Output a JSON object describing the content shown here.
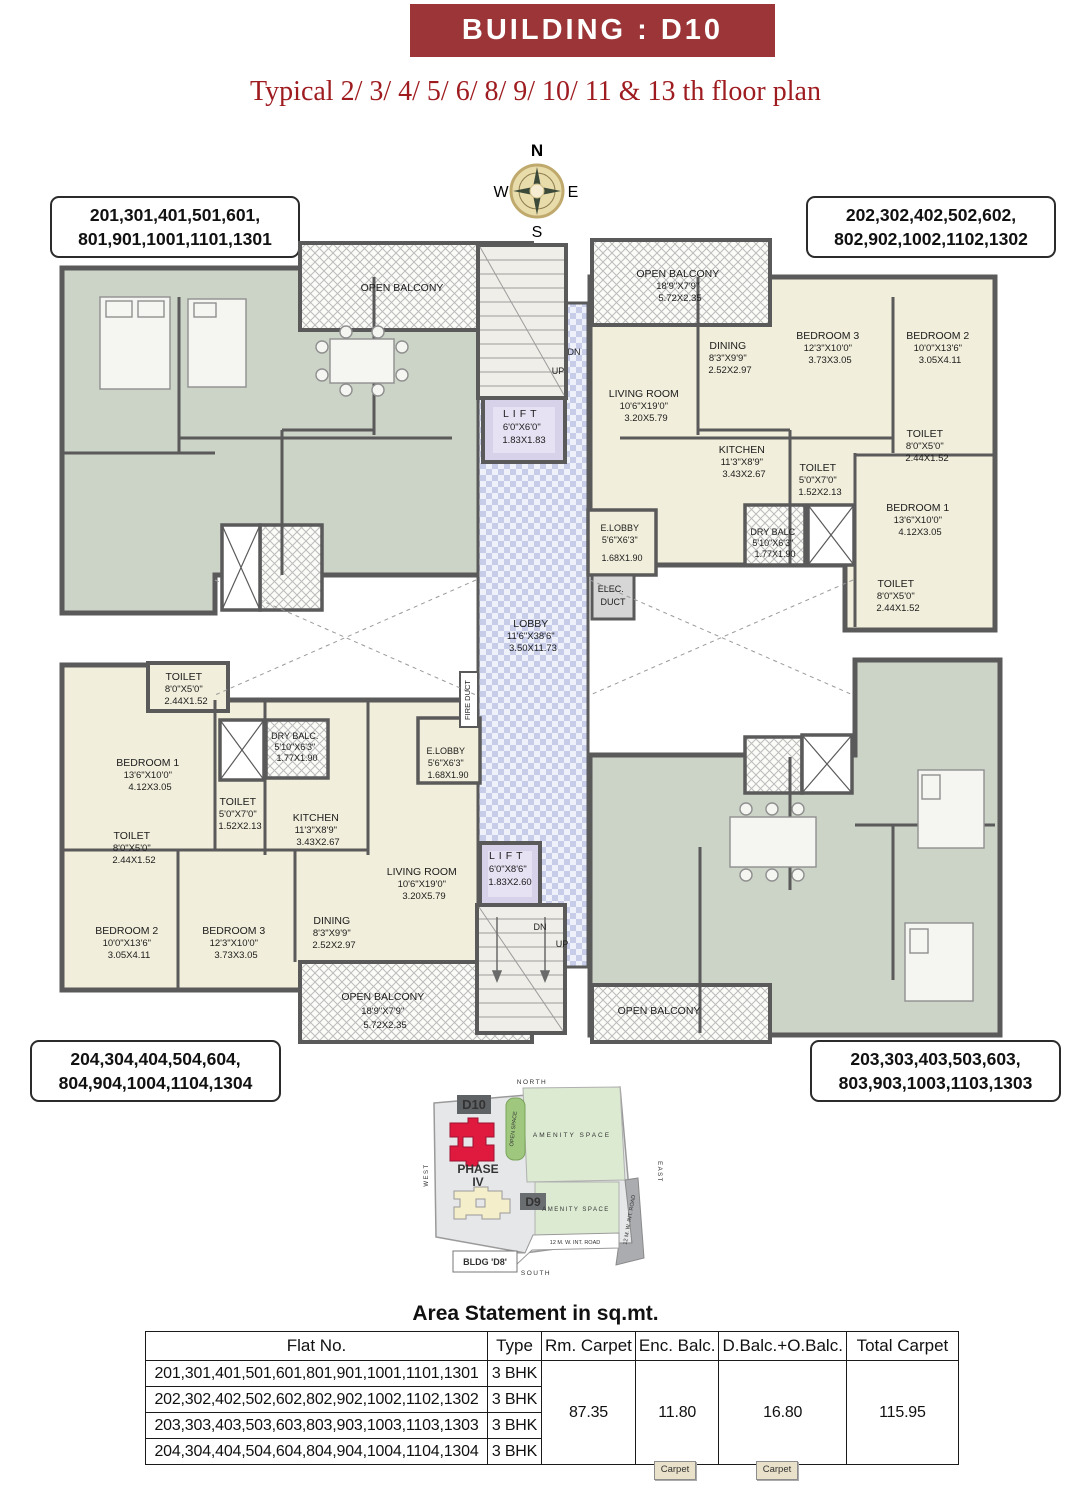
{
  "header": {
    "title": "BUILDING : D10",
    "subtitle": "Typical 2/ 3/ 4/ 5/ 6/ 8/ 9/ 10/ 11 & 13 th floor plan"
  },
  "compass": {
    "n": "N",
    "e": "E",
    "s": "S",
    "w": "W"
  },
  "unit_labels": {
    "top_left": [
      "201,301,401,501,601,",
      "801,901,1001,1101,1301"
    ],
    "top_right": [
      "202,302,402,502,602,",
      "802,902,1002,1102,1302"
    ],
    "bottom_left": [
      "204,304,404,504,604,",
      "804,904,1004,1104,1304"
    ],
    "bottom_right": [
      "203,303,403,503,603,",
      "803,903,1003,1103,1303"
    ]
  },
  "plan": {
    "rooms": {
      "tr_open_balcony": {
        "name": "OPEN BALCONY",
        "ft": "18'9\"X7'9\"",
        "m": "5.72X2.35"
      },
      "tr_dining": {
        "name": "DINING",
        "ft": "8'3\"X9'9\"",
        "m": "2.52X2.97"
      },
      "tr_bedroom3": {
        "name": "BEDROOM 3",
        "ft": "12'3\"X10'0\"",
        "m": "3.73X3.05"
      },
      "tr_bedroom2": {
        "name": "BEDROOM 2",
        "ft": "10'0\"X13'6\"",
        "m": "3.05X4.11"
      },
      "tr_living": {
        "name": "LIVING ROOM",
        "ft": "10'6\"X19'0\"",
        "m": "3.20X5.79"
      },
      "tr_kitchen": {
        "name": "KITCHEN",
        "ft": "11'3\"X8'9\"",
        "m": "3.43X2.67"
      },
      "tr_toilet_mid": {
        "name": "TOILET",
        "ft": "5'0\"X7'0\"",
        "m": "1.52X2.13"
      },
      "tr_toilet_top": {
        "name": "TOILET",
        "ft": "8'0\"X5'0\"",
        "m": "2.44X1.52"
      },
      "tr_bedroom1": {
        "name": "BEDROOM 1",
        "ft": "13'6\"X10'0\"",
        "m": "4.12X3.05"
      },
      "tr_toilet_bottom": {
        "name": "TOILET",
        "ft": "8'0\"X5'0\"",
        "m": "2.44X1.52"
      },
      "tr_dry_balc": {
        "name": "DRY BALC",
        "ft": "5'10\"X6'3\"",
        "m": "1.77X1.90"
      },
      "tr_e_lobby": {
        "name": "E.LOBBY",
        "ft": "5'6\"X6'3\"",
        "m": "1.68X1.90"
      },
      "elec_duct": {
        "line1": "ELEC.",
        "line2": "DUCT"
      },
      "lift_top": {
        "name": "LIFT",
        "ft": "6'0\"X6'0\"",
        "m": "1.83X1.83"
      },
      "lobby": {
        "name": "LOBBY",
        "ft": "11'6\"X38'6\"",
        "m": "3.50X11.73"
      },
      "lift_bottom": {
        "name": "LIFT",
        "ft": "6'0\"X8'6\"",
        "m": "1.83X2.60"
      },
      "bl_toilet_top": {
        "name": "TOILET",
        "ft": "8'0\"X5'0\"",
        "m": "2.44X1.52"
      },
      "bl_bedroom1": {
        "name": "BEDROOM 1",
        "ft": "13'6\"X10'0\"",
        "m": "4.12X3.05"
      },
      "bl_dry_balc": {
        "name": "DRY BALC.",
        "ft": "5'10\"X6'3\"",
        "m": "1.77X1.90"
      },
      "bl_toilet_mid": {
        "name": "TOILET",
        "ft": "5'0\"X7'0\"",
        "m": "1.52X2.13"
      },
      "bl_kitchen": {
        "name": "KITCHEN",
        "ft": "11'3\"X8'9\"",
        "m": "3.43X2.67"
      },
      "bl_e_lobby": {
        "name": "E.LOBBY",
        "ft": "5'6\"X6'3\"",
        "m": "1.68X1.90"
      },
      "bl_toilet_left": {
        "name": "TOILET",
        "ft": "8'0\"X5'0\"",
        "m": "2.44X1.52"
      },
      "bl_living": {
        "name": "LIVING ROOM",
        "ft": "10'6\"X19'0\"",
        "m": "3.20X5.79"
      },
      "bl_bedroom2": {
        "name": "BEDROOM 2",
        "ft": "10'0\"X13'6\"",
        "m": "3.05X4.11"
      },
      "bl_bedroom3": {
        "name": "BEDROOM 3",
        "ft": "12'3\"X10'0\"",
        "m": "3.73X3.05"
      },
      "bl_dining": {
        "name": "DINING",
        "ft": "8'3\"X9'9\"",
        "m": "2.52X2.97"
      },
      "bl_open_balcony": {
        "name": "OPEN BALCONY",
        "ft": "18'9\"X7'9\"",
        "m": "5.72X2.35"
      },
      "tl_open_balcony": {
        "name": "OPEN BALCONY"
      },
      "br_open_balcony": {
        "name": "OPEN BALCONY"
      }
    },
    "stairs": {
      "dn": "DN",
      "up": "UP"
    },
    "fire_duct": "FIRE DUCT"
  },
  "site_map": {
    "north": "NORTH",
    "south": "SOUTH",
    "east": "EAST",
    "west": "WEST",
    "d10": "D10",
    "d9": "D9",
    "phase_line1": "PHASE",
    "phase_line2": "IV",
    "open_space": "OPEN SPACE",
    "amenity_space": "AMENITY SPACE",
    "int_road": "12 M. W. INT. ROAD",
    "bldg_d8": "BLDG 'D8'"
  },
  "area_table": {
    "title": "Area Statement in sq.mt.",
    "headers": [
      "Flat No.",
      "Type",
      "Rm. Carpet",
      "Enc. Balc.",
      "D.Balc.+O.Balc.",
      "Total Carpet"
    ],
    "rows": [
      {
        "flats": "201,301,401,501,601,801,901,1001,1101,1301",
        "type": "3 BHK"
      },
      {
        "flats": "202,302,402,502,602,802,902,1002,1102,1302",
        "type": "3 BHK"
      },
      {
        "flats": "203,303,403,503,603,803,903,1003,1103,1303",
        "type": "3 BHK"
      },
      {
        "flats": "204,304,404,504,604,804,904,1004,1104,1304",
        "type": "3 BHK"
      }
    ],
    "merged": {
      "rm_carpet": "87.35",
      "enc_balc": "11.80",
      "d_o_balc": "16.80",
      "total_carpet": "115.95"
    },
    "carpet_chip": "Carpet"
  },
  "colors": {
    "accent_maroon": "#9c3537",
    "subtitle_red": "#9e1b1f",
    "plan_cream": "#f1eedb",
    "plan_green": "#ccd3c7",
    "lobby_blue": "#c7cde9",
    "lift_lavender": "#d8d1ea",
    "wall_gray": "#5a5a5a",
    "d10_red": "#e01a3f",
    "amenity_green": "#dcead2",
    "open_space_green": "#9fc87e"
  }
}
